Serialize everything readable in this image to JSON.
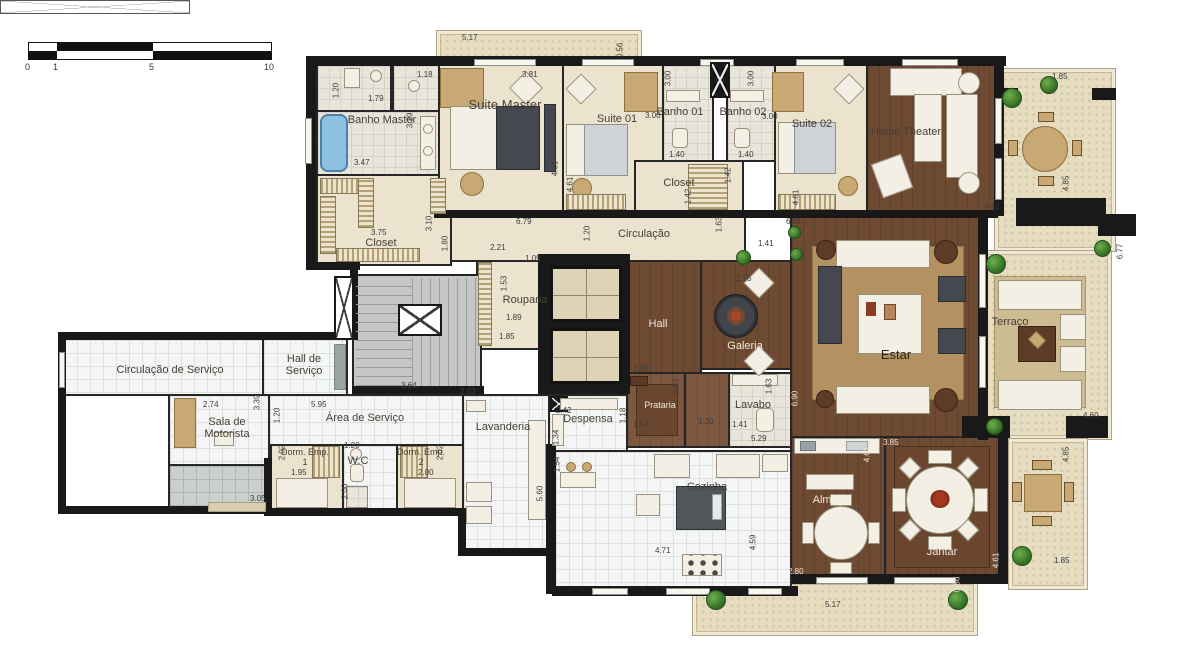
{
  "scale_bar": {
    "labels": [
      "0",
      "1",
      "5",
      "10"
    ]
  },
  "rooms": {
    "banho_master": "Banho Master",
    "suite_master": "Suite Master",
    "suite_01": "Suite 01",
    "banho_01": "Banho 01",
    "banho_02": "Banho 02",
    "suite_02": "Suite 02",
    "home_theater": "Home Theater",
    "closet_master": "Closet",
    "circulacao": "Circulação",
    "closet_suites": "Closet",
    "rouparia": "Rouparia",
    "hall": "Hall",
    "galeria": "Galeria",
    "estar": "Estar",
    "terraco": "Terraço",
    "circulacao_servico": "Circulação de Serviço",
    "hall_servico": "Hall de Serviço",
    "sala_motorista": "Sala de Motorista",
    "area_servico": "Área de Serviço",
    "dorm_emp_1": "Dorm. Emp. 1",
    "wc": "W.C",
    "dorm_emp_2": "Dorm. Emp. 2",
    "lavanderia": "Lavanderia",
    "despensa": "Despensa",
    "prataria": "Prataria",
    "lavabo": "Lavabo",
    "cozinha": "Cozinha",
    "almoco": "Almoço",
    "jantar": "Jantar"
  },
  "dims": [
    "5.17",
    "0.56",
    "1.20",
    "1.79",
    "1.18",
    "3.81",
    "3.29",
    "3.47",
    "4.61",
    "4.61",
    "3.00",
    "3.00",
    "1.40",
    "3.00",
    "1.40",
    "3.00",
    "4.61",
    "1.42",
    "1.42",
    "1.85",
    "4.42",
    "4.85",
    "3.75",
    "3.10",
    "1.80",
    "2.21",
    "1.09",
    "6.79",
    "1.20",
    "1.63",
    "1.41",
    "6.01",
    "2.75",
    "1.53",
    "1.89",
    "1.85",
    "3.64",
    "2.83",
    "6.77",
    "4.60",
    "2.74",
    "3.39",
    "1.20",
    "5.95",
    "3.05",
    "2.02",
    "1.95",
    "1.20",
    "2.00",
    "2.02",
    "2.00",
    "5.60",
    "1.54",
    "2.42",
    "1.34",
    "1.18",
    "1.55",
    "1.54",
    "1.63",
    "1.20",
    "1.41",
    "1.63",
    "5.29",
    "6.90",
    "4.71",
    "4.59",
    "2.80",
    "4.61",
    "3.85",
    "4.61",
    "0.86",
    "5.17",
    "4.85",
    "1.85"
  ],
  "colors": {
    "wall": "#191919",
    "wood_floor": "#6e4a33",
    "cream_floor": "#ebe3ce",
    "service_tile": "#f4f6f5",
    "terrace_stone": "#e6dcc0",
    "bathtub": "#8ec0e0",
    "plant": "#2f6b22"
  }
}
